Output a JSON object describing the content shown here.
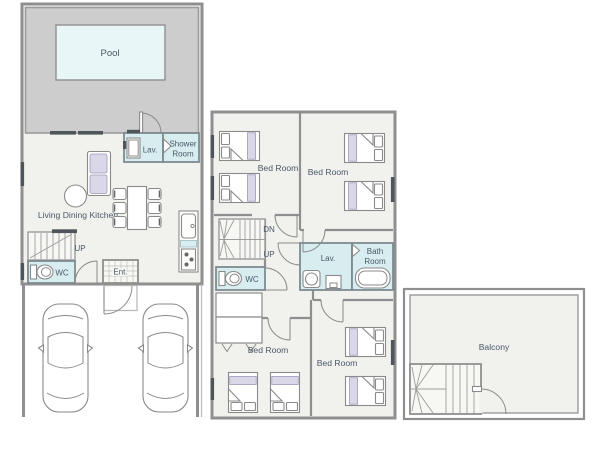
{
  "colors": {
    "floor": "#f1f1ee",
    "deck": "#cdcdcd",
    "pool_water": "#e9f6f8",
    "wet_room": "#d8edf0",
    "stair_floor": "#f7f7f4",
    "wall": "#8f8f8f",
    "line": "#8a8a8a",
    "lavender": "#dad7e9",
    "window": "#4e565c",
    "text": "#4a5868"
  },
  "first_floor": {
    "pool": "Pool",
    "lav": "Lav.",
    "shower_line1": "Shower",
    "shower_line2": "Room",
    "ldk": "Living Dining Kitchen",
    "up": "UP",
    "wc": "WC",
    "entrance": "Ent."
  },
  "second_floor": {
    "bedroom_nw": "Bed Room",
    "bedroom_ne": "Bed Room",
    "bedroom_sw": "Bed Room",
    "bedroom_se": "Bed Room",
    "dn": "DN",
    "up": "UP",
    "lav": "Lav.",
    "bath_line1": "Bath",
    "bath_line2": "Room",
    "wc": "WC"
  },
  "balcony": {
    "label": "Balcony"
  }
}
